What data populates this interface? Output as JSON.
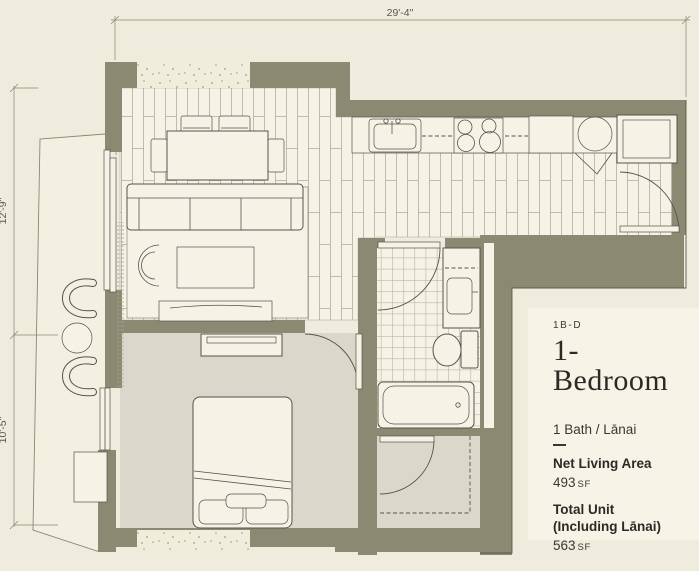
{
  "dims": {
    "top": "29'-4\"",
    "left_upper": "12'-9\"",
    "left_lower": "10'-5\""
  },
  "panel": {
    "unit_code": "1B-D",
    "unit_name": "1-Bedroom",
    "features": "1 Bath / Lānai",
    "net_living": {
      "label": "Net Living Area",
      "value": "493",
      "unit": "SF"
    },
    "total_unit": {
      "label_line1": "Total Unit",
      "label_line2": "(Including Lānai)",
      "value": "563",
      "unit": "SF"
    }
  },
  "colors": {
    "bg": "#efecdd",
    "panel": "#f7f4e7",
    "wall": "#8b8971",
    "floor": "#f6f3e6",
    "carpet": "#dbd7ca",
    "lanai": "#f3f0e2",
    "plank_line": "#aaa593",
    "tile_line": "#bab5a2",
    "speckle_bg": "#f1eddc",
    "speckle_dot": "#a19c85",
    "line": "#55534a",
    "line_dk": "#5c5a4c",
    "dim": "#8a8776",
    "dim_text": "#5b584c",
    "text": "#3a3830",
    "title_text": "#2c2a24"
  }
}
